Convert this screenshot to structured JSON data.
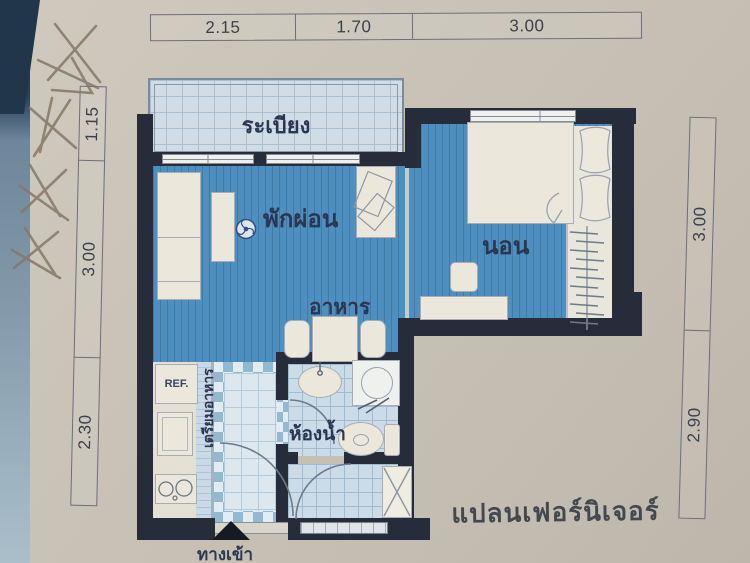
{
  "document": {
    "type": "floor-plan-photo",
    "plan_title": "แปลนเฟอร์นิเจอร์",
    "handwritten_marks": {
      "count": 4,
      "style": "pencil cross-out scribbles, top-left of paper"
    }
  },
  "dimensions": {
    "unit": "meters",
    "top": [
      "2.15",
      "1.70",
      "3.00"
    ],
    "left": [
      "1.15",
      "3.00",
      "2.30"
    ],
    "right": [
      "3.00",
      "2.90"
    ]
  },
  "rooms": {
    "balcony": {
      "label": "ระเบียง"
    },
    "living": {
      "label": "พักผ่อน"
    },
    "bedroom": {
      "label": "นอน"
    },
    "dining": {
      "label": "อาหาร"
    },
    "bathroom": {
      "label": "ห้องน้ำ"
    },
    "kitchen": {
      "label": "เตรียมอาหาร"
    },
    "refrigerator": {
      "label": "REF."
    }
  },
  "entrance": {
    "label": "ทางเข้า",
    "icon": "triangle-up-arrow"
  },
  "icons": {
    "ceiling_fan": "fan-circle",
    "wardrobe_hangers": "clothes-hanger-lines",
    "service_shaft": "x-cross-box"
  },
  "colors": {
    "paper": "#c9c3b7",
    "wall_dark": "#262c3a",
    "floor_blue": "#4e8fbf",
    "tile_light": "#cbdce8",
    "furniture": "#ebe7db",
    "label_text": "#2b3652",
    "photo_edge_dark": "#22364b",
    "photo_edge_light": "#849aab"
  }
}
